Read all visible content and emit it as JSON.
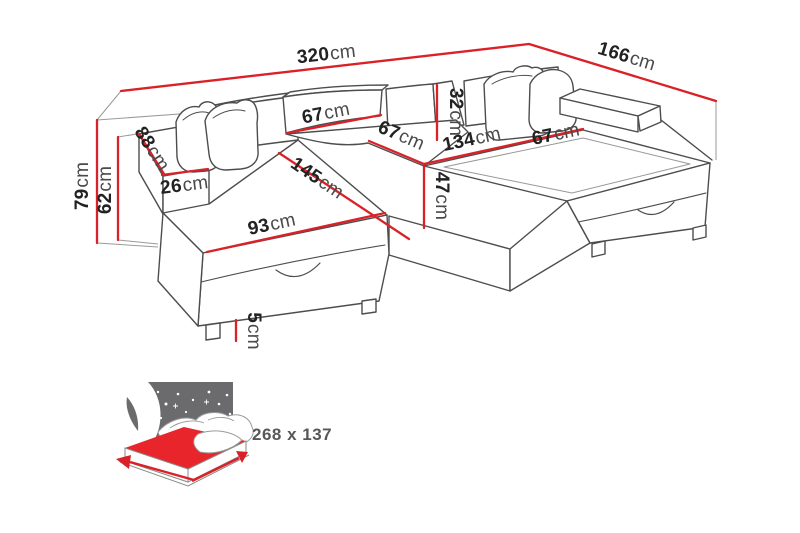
{
  "diagram": {
    "type": "furniture-dimension-diagram",
    "subject": "U-shaped corner sofa bed with storage, annotated with measurements",
    "unit": "cm",
    "dimensions": {
      "total_width": {
        "v": "320",
        "u": "cm"
      },
      "total_depth": {
        "v": "166",
        "u": "cm"
      },
      "total_height": {
        "v": "79",
        "u": "cm"
      },
      "armrest_height": {
        "v": "62",
        "u": "cm"
      },
      "armrest_length": {
        "v": "88",
        "u": "cm"
      },
      "armrest_width": {
        "v": "26",
        "u": "cm"
      },
      "backrest_width": {
        "v": "67",
        "u": "cm"
      },
      "middle_seat_width": {
        "v": "67",
        "u": "cm"
      },
      "backrest_height": {
        "v": "32",
        "u": "cm"
      },
      "right_seat_length": {
        "v": "134",
        "u": "cm"
      },
      "right_seat_width": {
        "v": "67",
        "u": "cm"
      },
      "chaise_length": {
        "v": "145",
        "u": "cm"
      },
      "chaise_width": {
        "v": "93",
        "u": "cm"
      },
      "seat_height": {
        "v": "47",
        "u": "cm"
      },
      "leg_height": {
        "v": "5",
        "u": "cm"
      }
    },
    "sofa_bed_icon": {
      "sleeping_area": "268 x 137"
    },
    "colors": {
      "dimension_line": "#da2128",
      "outline": "#4d4d4d",
      "icon_gray": "#6b6b6d",
      "icon_red": "#e8252b",
      "text": "#222222"
    }
  }
}
